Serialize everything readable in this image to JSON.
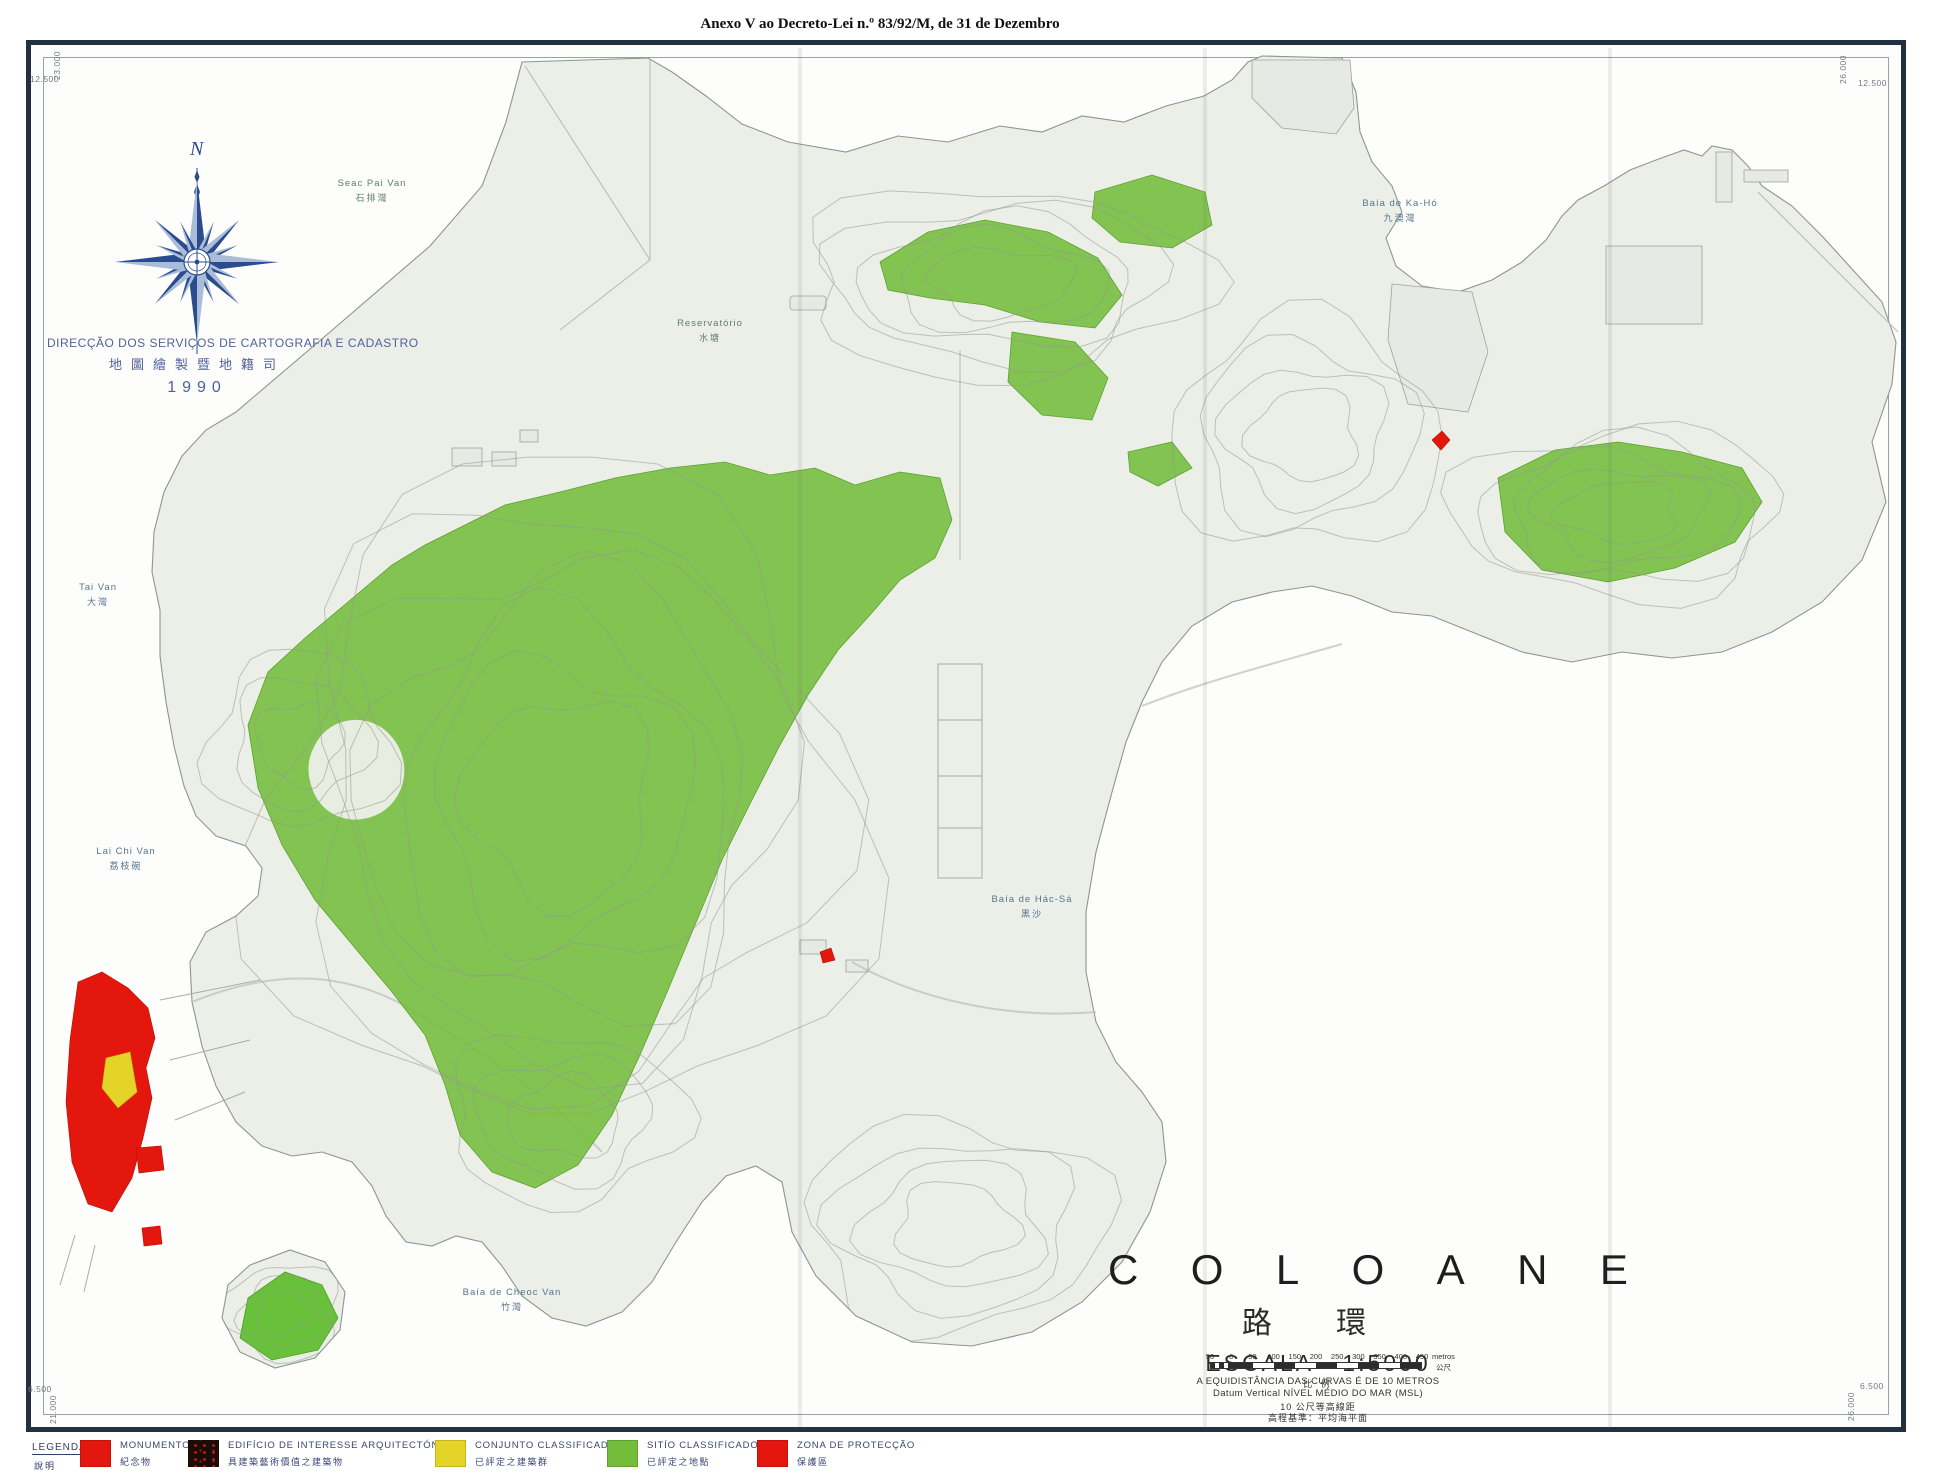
{
  "header": {
    "title": "Anexo V ao Decreto-Lei n.º 83/92/M, de 31 de Dezembro"
  },
  "agency": {
    "name_pt": "DIRECÇÃO DOS SERVIÇOS DE CARTOGRAFIA E CADASTRO",
    "name_zh": "地圖繪製暨地籍司",
    "year": "1990",
    "compass_north": "N"
  },
  "corner_coords": {
    "top_left": {
      "x_label": "12.500",
      "y_label": "23.000"
    },
    "top_right": {
      "x_label": "12.500",
      "y_label": "26.000"
    },
    "bottom_left": {
      "x_label": "6.500",
      "y_label": "21.000"
    },
    "bottom_right": {
      "x_label": "6.500",
      "y_label": "26.000"
    }
  },
  "place_labels": [
    {
      "pt": "Seac Pai Van",
      "zh": "石排灣"
    },
    {
      "pt": "Reservatório",
      "zh": "水塘"
    },
    {
      "pt": "Baía de Ka-Hó",
      "zh": "九澳灣"
    },
    {
      "pt": "Tai Van",
      "zh": "大灣"
    },
    {
      "pt": "Lai Chi Van",
      "zh": "荔枝碗"
    },
    {
      "pt": "Baía de Hác-Sá",
      "zh": "黑沙"
    },
    {
      "pt": "Baía de Cheoc Van",
      "zh": "竹灣"
    }
  ],
  "title_block": {
    "title": "COLOANE",
    "title_zh": "路 環",
    "scale_label": "ESCALA",
    "scale_value": "1:5000",
    "scale_zh": "比 例",
    "note_pt1": "A EQUIDISTÂNCIA DAS CURVAS É DE 10 METROS",
    "note_pt2": "Datum Vertical NÍVEL MÉDIO DO MAR (MSL)",
    "note_zh1": "10 公尺等高線距",
    "note_zh2": "高程基準：平均海平面"
  },
  "scale_bar": {
    "ticks": [
      "50",
      "0",
      "50",
      "100",
      "150",
      "200",
      "250",
      "300",
      "350",
      "400",
      "450"
    ],
    "unit_pt": "metros",
    "unit_zh": "公尺"
  },
  "legend": {
    "title": "LEGENDA",
    "title_zh": "說明",
    "items": [
      {
        "label_pt": "MONUMENTO",
        "label_zh": "紀念物",
        "color": "#e3170d",
        "style": "solid"
      },
      {
        "label_pt": "EDIFÍCIO DE INTERESSE ARQUITECTÓNICO",
        "label_zh": "具建築藝術價值之建築物",
        "color": "#1a0d07",
        "style": "speckled"
      },
      {
        "label_pt": "CONJUNTO CLASSIFICADO",
        "label_zh": "已評定之建築群",
        "color": "#e5d428",
        "style": "solid"
      },
      {
        "label_pt": "SITÍO CLASSIFICADO",
        "label_zh": "已評定之地點",
        "color": "#74bd3b",
        "style": "solid"
      },
      {
        "label_pt": "ZONA DE PROTECÇÃO",
        "label_zh": "保護區",
        "color": "#e3170d",
        "style": "solid"
      }
    ]
  },
  "colors": {
    "site-green": "#74bd3b",
    "monument-red": "#e3170d",
    "conjunto-yellow": "#e5d428",
    "compass-blue": "#2b4b8f",
    "agency-blue": "#51619b",
    "land": "#ecefe8"
  }
}
